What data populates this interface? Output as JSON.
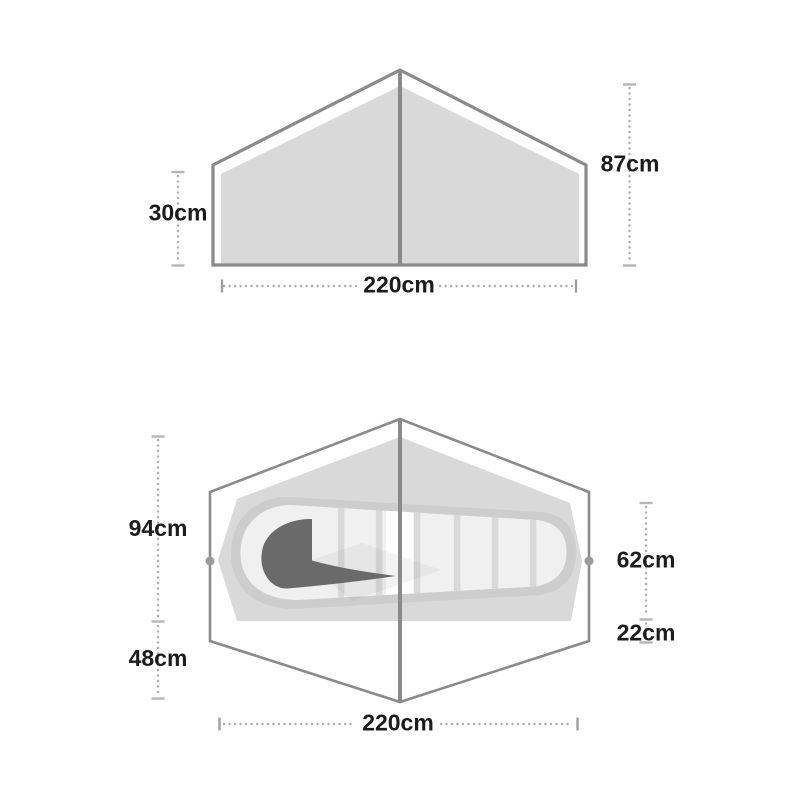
{
  "side_view": {
    "labels": {
      "wall_height": "30cm",
      "peak_height": "87cm",
      "base_width": "220cm"
    }
  },
  "floor_plan": {
    "labels": {
      "inner_depth": "94cm",
      "porch_depth": "48cm",
      "foot_width": "62cm",
      "foot_offset": "22cm",
      "base_length": "220cm"
    }
  },
  "colors": {
    "outline_gray": "#8a8a8a",
    "panel_fill": "#d9d9d9",
    "mat_ring": "#cdcdcd",
    "mat_fill": "#f0f0f0",
    "mat_rib": "#d9d9d9",
    "sleeping_bag_dark": "#6a6a6a",
    "guy_point_dot": "#9a9a9a",
    "dim_dots": "#ababab",
    "label_text": "#1c1c1c",
    "background": "#ffffff"
  }
}
